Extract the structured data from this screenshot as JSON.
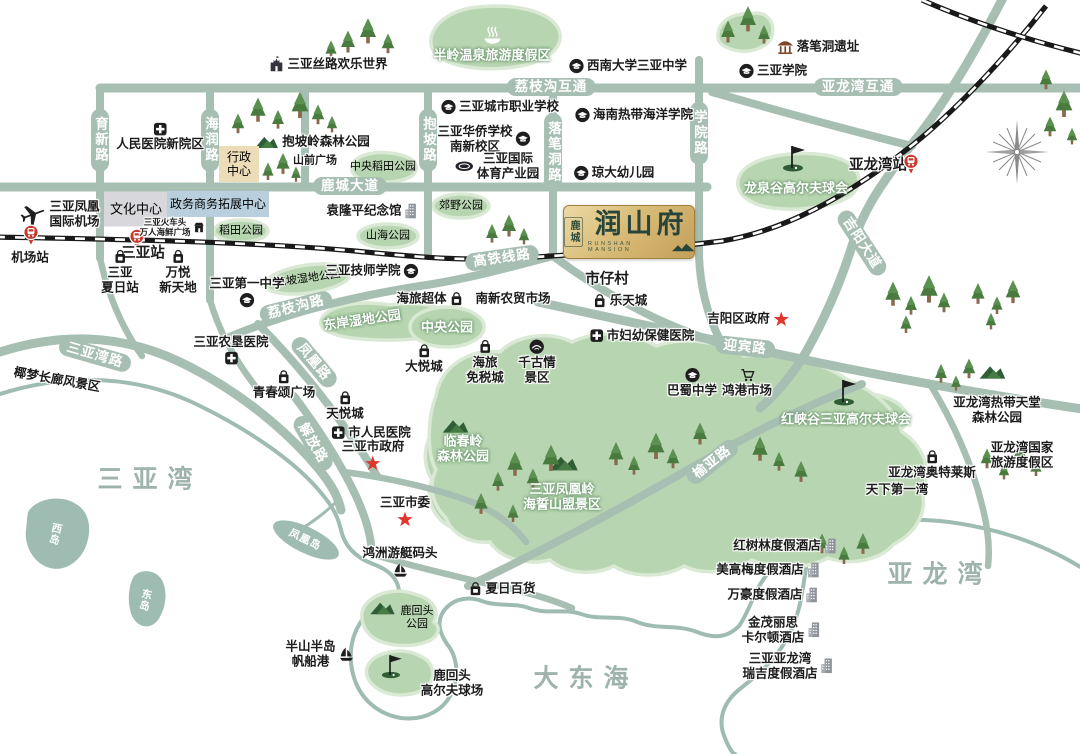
{
  "logo": {
    "district": "鹿城",
    "name": "润山府",
    "sub": "RUNSHAN MANSION",
    "village_below": "市仔村"
  },
  "colors": {
    "road": "#a7bfb3",
    "park_fill": "#b8d5b1",
    "park_edge": "#d9e9d4",
    "island": "#9fbcb2",
    "railway": "#191919",
    "accent_red": "#d6372e",
    "gold": "#d9bc78",
    "logo_text": "#27453a",
    "sea_text": "#9db3ab"
  },
  "sea_labels": [
    {
      "name": "sea-sanya-bay",
      "text": "三亚湾",
      "x": 150,
      "y": 480
    },
    {
      "name": "sea-dadonghai",
      "text": "大东海",
      "x": 586,
      "y": 679
    },
    {
      "name": "sea-yalong-bay",
      "text": "亚龙湾",
      "x": 940,
      "y": 575
    }
  ],
  "island_labels": [
    {
      "name": "island-west",
      "text": "西岛",
      "x": 55,
      "y": 534,
      "vertical": true,
      "rot": 12
    },
    {
      "name": "island-east",
      "text": "东岛",
      "x": 145,
      "y": 600,
      "vertical": true,
      "rot": 12
    },
    {
      "name": "island-phoenix",
      "text": "凤凰岛",
      "x": 305,
      "y": 540,
      "rot": 26
    }
  ],
  "road_labels": [
    {
      "name": "road-yuxin",
      "text": "育新路",
      "x": 100,
      "y": 140,
      "vertical": true
    },
    {
      "name": "road-hairun",
      "text": "海润路",
      "x": 210,
      "y": 140,
      "vertical": true
    },
    {
      "name": "road-baopo",
      "text": "抱坡路",
      "x": 428,
      "y": 140,
      "vertical": true
    },
    {
      "name": "road-luobidong",
      "text": "落笔洞路",
      "x": 553,
      "y": 152,
      "vertical": true
    },
    {
      "name": "road-xueyuan",
      "text": "学院路",
      "x": 699,
      "y": 133,
      "vertical": true
    },
    {
      "name": "road-lizhigou-interchange",
      "text": "荔枝沟互通",
      "x": 551,
      "y": 87
    },
    {
      "name": "road-yalongwan-interchange",
      "text": "亚龙湾互通",
      "x": 858,
      "y": 87
    },
    {
      "name": "road-lucheng-avenue",
      "text": "鹿城大道",
      "x": 350,
      "y": 186
    },
    {
      "name": "road-hsr-line",
      "text": "高铁线路",
      "x": 502,
      "y": 258,
      "rot": -8
    },
    {
      "name": "road-lizhigou",
      "text": "荔枝沟路",
      "x": 296,
      "y": 307,
      "rot": -14
    },
    {
      "name": "road-fenghuang",
      "text": "凤凰路",
      "x": 314,
      "y": 362,
      "rot": 50
    },
    {
      "name": "road-sanyawan",
      "text": "三亚湾路",
      "x": 95,
      "y": 355,
      "rot": 16
    },
    {
      "name": "road-jiefang",
      "text": "解放路",
      "x": 313,
      "y": 443,
      "rot": 60
    },
    {
      "name": "road-yingbin",
      "text": "迎宾路",
      "x": 745,
      "y": 347,
      "rot": 6
    },
    {
      "name": "road-yuya",
      "text": "榆亚路",
      "x": 712,
      "y": 462,
      "rot": -38
    },
    {
      "name": "road-jiyang-avenue",
      "text": "吉阳大道",
      "x": 862,
      "y": 243,
      "rot": 57
    }
  ],
  "boxes": [
    {
      "name": "culture-center",
      "text": "文化中心",
      "x": 136,
      "y": 209,
      "w": 64,
      "h": 35,
      "cls": "box-gray",
      "fs": 13
    },
    {
      "name": "gov-business-center",
      "text": "政务商务拓展中心",
      "x": 218,
      "y": 204,
      "w": 102,
      "h": 26,
      "cls": "box-blue",
      "fs": 12
    },
    {
      "name": "admin-center",
      "lines": [
        "行政",
        "中心"
      ],
      "x": 239,
      "y": 164,
      "w": 40,
      "h": 36,
      "cls": "box-tan",
      "fs": 12
    }
  ],
  "parks": [
    {
      "name": "banling-hotspring-resort",
      "text": "半岭温泉旅游度假区",
      "x": 492,
      "y": 44,
      "icon": "hotspring",
      "iconPos": "above"
    },
    {
      "name": "central-paddy-park",
      "text": "中央稻田公园",
      "x": 383,
      "y": 167,
      "cls": "park-sm"
    },
    {
      "name": "paddy-park",
      "text": "稻田公园",
      "x": 241,
      "y": 231,
      "cls": "park-sm"
    },
    {
      "name": "shanhai-park",
      "text": "山海公园",
      "x": 388,
      "y": 236,
      "cls": "park-sm"
    },
    {
      "name": "country-park",
      "text": "郊野公园",
      "x": 461,
      "y": 206,
      "cls": "park-sm"
    },
    {
      "name": "baopo-wetland-park",
      "text": "抱坡湿地公园",
      "x": 308,
      "y": 279,
      "rot": -8,
      "cls": "park-sm"
    },
    {
      "name": "dongan-wetland-park",
      "text": "东岸湿地公园",
      "x": 362,
      "y": 320,
      "rot": -8
    },
    {
      "name": "central-park",
      "text": "中央公园",
      "x": 447,
      "y": 327
    },
    {
      "name": "longquangu-golf-club",
      "text": "龙泉谷高尔夫球会",
      "x": 796,
      "y": 188
    },
    {
      "name": "hongxiagu-golf-club",
      "text": "红峡谷三亚高尔夫球会",
      "x": 846,
      "y": 419
    },
    {
      "name": "linchunling-forest-park",
      "lines": [
        "临春岭",
        "森林公园"
      ],
      "x": 463,
      "y": 449
    },
    {
      "name": "phoenix-ridge-scenic-area",
      "lines": [
        "三亚凤凰岭",
        "海誓山盟景区"
      ],
      "x": 562,
      "y": 497
    },
    {
      "name": "luhuitou-park",
      "lines": [
        "鹿回头",
        "公园"
      ],
      "x": 417,
      "y": 618,
      "cls": "park-sm"
    }
  ],
  "pois": [
    {
      "name": "silk-road-happy-world",
      "text": "三亚丝路欢乐世界",
      "x": 328,
      "y": 64,
      "icon": "castle",
      "iconPos": "left"
    },
    {
      "name": "swu-sanya-middle-school",
      "text": "西南大学三亚中学",
      "x": 628,
      "y": 66,
      "icon": "school",
      "iconPos": "left"
    },
    {
      "name": "luobidong-ruins",
      "text": "落笔洞遗址",
      "x": 818,
      "y": 47,
      "icon": "pavilion",
      "iconPos": "left"
    },
    {
      "name": "sanya-college",
      "text": "三亚学院",
      "x": 773,
      "y": 71,
      "icon": "school",
      "iconPos": "left"
    },
    {
      "name": "renmin-hospital-new-campus",
      "text": "人民医院新院区",
      "x": 160,
      "y": 137,
      "icon": "hospital",
      "iconPos": "above"
    },
    {
      "name": "baopoling-forest-park",
      "text": "抱坡岭森林公园",
      "x": 326,
      "y": 142
    },
    {
      "name": "shanqian-square",
      "text": "山前广场",
      "x": 315,
      "y": 161,
      "cls": "poi poi-sm"
    },
    {
      "name": "city-vocational-school",
      "text": "三亚城市职业学校",
      "x": 500,
      "y": 107,
      "icon": "school",
      "iconPos": "left"
    },
    {
      "name": "overseas-chinese-school",
      "lines": [
        "三亚华侨学校",
        "南新校区"
      ],
      "x": 484,
      "y": 139,
      "icon": "school",
      "iconPos": "right"
    },
    {
      "name": "hainan-tropical-ocean-university",
      "text": "海南热带海洋学院",
      "x": 634,
      "y": 115,
      "icon": "school",
      "iconPos": "left"
    },
    {
      "name": "intl-sports-industry-park",
      "lines": [
        "三亚国际",
        "体育产业园"
      ],
      "x": 497,
      "y": 166,
      "icon": "stadium",
      "iconPos": "left"
    },
    {
      "name": "qiongda-kindergarten",
      "text": "琼大幼儿园",
      "x": 614,
      "y": 173,
      "icon": "school",
      "iconPos": "left"
    },
    {
      "name": "yalongwan-station-label",
      "text": "亚龙湾站",
      "x": 878,
      "y": 166,
      "cls": "poi poi-lg"
    },
    {
      "name": "yalongwan-station-badge",
      "x": 911,
      "y": 164,
      "icon": "station"
    },
    {
      "name": "phoenix-intl-airport",
      "lines": [
        "三亚凤凰",
        "国际机场"
      ],
      "x": 60,
      "y": 214,
      "icon": "plane",
      "iconPos": "left"
    },
    {
      "name": "airport-station-badge",
      "x": 31,
      "y": 235,
      "icon": "station"
    },
    {
      "name": "airport-station-label",
      "text": "机场站",
      "x": 30,
      "y": 258
    },
    {
      "name": "sanya-station-badge",
      "x": 137,
      "y": 239,
      "icon": "station"
    },
    {
      "name": "sanya-station-label",
      "text": "三亚站",
      "x": 143,
      "y": 254,
      "cls": "poi poi-lg"
    },
    {
      "name": "seafood-plaza",
      "lines": [
        "三亚火车头",
        "万人海鲜广场"
      ],
      "x": 172,
      "y": 227,
      "cls": "poi tiny",
      "icon": "shop",
      "iconPos": "right"
    },
    {
      "name": "xiari-station",
      "lines": [
        "三亚",
        "夏日站"
      ],
      "x": 120,
      "y": 272,
      "icon": "bag",
      "iconPos": "above"
    },
    {
      "name": "wanyue-new-world",
      "lines": [
        "万悦",
        "新天地"
      ],
      "x": 178,
      "y": 272,
      "icon": "bag",
      "iconPos": "above"
    },
    {
      "name": "sanya-first-middle-school",
      "text": "三亚第一中学",
      "x": 247,
      "y": 292,
      "icon": "school",
      "iconPos": "below"
    },
    {
      "name": "yuanlongping-memorial",
      "text": "袁隆平纪念馆",
      "x": 372,
      "y": 211,
      "icon": "building",
      "iconPos": "right"
    },
    {
      "name": "shizai-village",
      "text": "市仔村",
      "x": 607,
      "y": 280,
      "cls": "poi poi-lg"
    },
    {
      "name": "skills-college",
      "text": "三亚技师学院",
      "x": 372,
      "y": 271,
      "icon": "school",
      "iconPos": "right"
    },
    {
      "name": "hailv-supertown",
      "text": "海旅超体",
      "x": 430,
      "y": 299,
      "icon": "bag",
      "iconPos": "right"
    },
    {
      "name": "nanxin-market",
      "text": "南新农贸市场",
      "x": 513,
      "y": 299
    },
    {
      "name": "letian-city",
      "text": "乐天城",
      "x": 620,
      "y": 301,
      "icon": "bag",
      "iconPos": "left"
    },
    {
      "name": "maternal-child-hospital",
      "text": "市妇幼保健医院",
      "x": 642,
      "y": 336,
      "icon": "hospital",
      "iconPos": "left"
    },
    {
      "name": "jiyang-district-gov",
      "text": "吉阳区政府",
      "x": 748,
      "y": 319,
      "icon": "star",
      "iconPos": "right"
    },
    {
      "name": "bashu-middle-school",
      "text": "巴蜀中学",
      "x": 692,
      "y": 383,
      "icon": "school",
      "iconPos": "above"
    },
    {
      "name": "honggang-market",
      "text": "鸿港市场",
      "x": 747,
      "y": 383,
      "icon": "cart",
      "iconPos": "above"
    },
    {
      "name": "agri-reclamation-hospital",
      "text": "三亚农垦医院",
      "x": 231,
      "y": 350,
      "icon": "hospital",
      "iconPos": "below"
    },
    {
      "name": "qingchunsong-square",
      "text": "青春颂广场",
      "x": 284,
      "y": 385,
      "icon": "bag",
      "iconPos": "above"
    },
    {
      "name": "tianyue-city",
      "text": "天悦城",
      "x": 345,
      "y": 406,
      "icon": "bag",
      "iconPos": "above"
    },
    {
      "name": "dayue-city",
      "text": "大悦城",
      "x": 424,
      "y": 359,
      "icon": "bag",
      "iconPos": "above"
    },
    {
      "name": "duty-free-city",
      "lines": [
        "海旅",
        "免税城"
      ],
      "x": 485,
      "y": 362,
      "icon": "bag",
      "iconPos": "above"
    },
    {
      "name": "qianguqing-scenic",
      "lines": [
        "千古情",
        "景区"
      ],
      "x": 537,
      "y": 362,
      "icon": "theater",
      "iconPos": "above"
    },
    {
      "name": "city-peoples-hospital",
      "text": "市人民医院",
      "x": 371,
      "y": 433,
      "icon": "hospital",
      "iconPos": "left"
    },
    {
      "name": "sanya-city-gov",
      "text": "三亚市政府",
      "x": 373,
      "y": 455,
      "icon": "star",
      "iconPos": "below"
    },
    {
      "name": "sanya-city-committee",
      "text": "三亚市委",
      "x": 405,
      "y": 511,
      "icon": "star",
      "iconPos": "below"
    },
    {
      "name": "hongzhou-yacht-marina",
      "text": "鸿洲游艇码头",
      "x": 400,
      "y": 562,
      "icon": "sail",
      "iconPos": "below"
    },
    {
      "name": "xiari-department-store",
      "text": "夏日百货",
      "x": 502,
      "y": 589,
      "icon": "bag",
      "iconPos": "left"
    },
    {
      "name": "luhuitou-golf-course",
      "lines": [
        "鹿回头",
        "高尔夫球场"
      ],
      "x": 452,
      "y": 683
    },
    {
      "name": "banshan-sailing-port",
      "lines": [
        "半山半岛",
        "帆船港"
      ],
      "x": 320,
      "y": 654,
      "icon": "sail",
      "iconPos": "right"
    },
    {
      "name": "yemeng-corridor-scenic",
      "text": "椰梦长廊风景区",
      "x": 57,
      "y": 380,
      "rot": 10
    },
    {
      "name": "tianxia-first-bay",
      "text": "天下第一湾",
      "x": 897,
      "y": 490
    },
    {
      "name": "yalong-paradise-forest-park",
      "lines": [
        "亚龙湾热带天堂",
        "森林公园"
      ],
      "x": 997,
      "y": 410
    },
    {
      "name": "yalong-national-resort",
      "lines": [
        "亚龙湾国家",
        "旅游度假区"
      ],
      "x": 1022,
      "y": 455
    },
    {
      "name": "yalong-outlets",
      "text": "亚龙湾奥特莱斯",
      "x": 932,
      "y": 465,
      "icon": "bag",
      "iconPos": "above"
    },
    {
      "name": "hotel-mangrove",
      "text": "红树林度假酒店",
      "x": 785,
      "y": 546,
      "icon": "building",
      "iconPos": "right"
    },
    {
      "name": "hotel-mgm",
      "text": "美高梅度假酒店",
      "x": 768,
      "y": 570,
      "icon": "building",
      "iconPos": "right"
    },
    {
      "name": "hotel-marriott",
      "text": "万豪度假酒店",
      "x": 773,
      "y": 595,
      "icon": "building",
      "iconPos": "right"
    },
    {
      "name": "hotel-ritz-carlton",
      "lines": [
        "金茂丽思",
        "卡尔顿酒店"
      ],
      "x": 781,
      "y": 630,
      "icon": "building",
      "iconPos": "right"
    },
    {
      "name": "hotel-st-regis",
      "lines": [
        "三亚亚龙湾",
        "瑞吉度假酒店"
      ],
      "x": 788,
      "y": 666,
      "icon": "building",
      "iconPos": "right"
    }
  ]
}
